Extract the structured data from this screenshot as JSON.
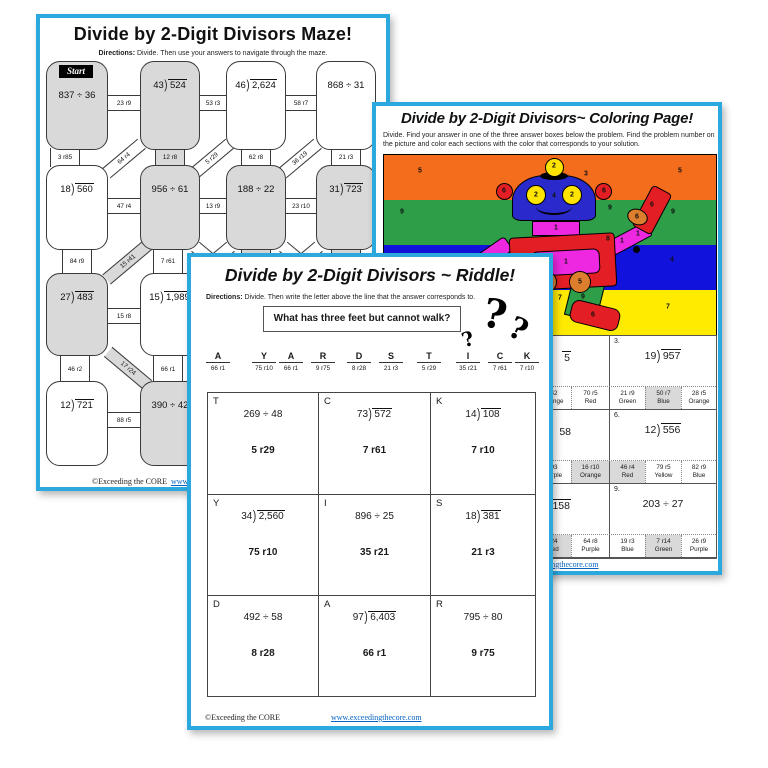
{
  "colors": {
    "page_border": "#2BA9DF",
    "shade_gray": "#D9D9D9",
    "stripe_orange": "#F36D1D",
    "stripe_green": "#2E9E49",
    "stripe_blue": "#1212DD",
    "stripe_yellow": "#FFEB00",
    "robot_blue": "#2929CC",
    "robot_red": "#E31E24",
    "robot_magenta": "#ED28E0",
    "robot_orange": "#DD7E2E",
    "robot_yellow": "#FFE400",
    "robot_green": "#2E9E49",
    "link_blue": "#0563C1"
  },
  "maze": {
    "title": "Divide by 2-Digit Divisors Maze!",
    "directions_label": "Directions:",
    "directions": "Divide. Then use your answers to navigate through the maze.",
    "start_label": "Start",
    "boxes": [
      {
        "problem": "837 ÷ 36",
        "row": 0,
        "col": 0,
        "shaded": true,
        "start": true
      },
      {
        "problem": "43)524",
        "row": 0,
        "col": 1,
        "shaded": true
      },
      {
        "problem": "46)2,624",
        "row": 0,
        "col": 2,
        "shaded": false
      },
      {
        "problem": "868 ÷ 31",
        "row": 0,
        "col": 3,
        "shaded": false
      },
      {
        "problem": "18)560",
        "row": 1,
        "col": 0,
        "shaded": false
      },
      {
        "problem": "956 ÷ 61",
        "row": 1,
        "col": 1,
        "shaded": true
      },
      {
        "problem": "188 ÷ 22",
        "row": 1,
        "col": 2,
        "shaded": true
      },
      {
        "problem": "31)723",
        "row": 1,
        "col": 3,
        "shaded": true
      },
      {
        "problem": "27)483",
        "row": 2,
        "col": 0,
        "shaded": true
      },
      {
        "problem": "15)1,989",
        "row": 2,
        "col": 1,
        "shaded": false
      },
      {
        "problem": "12)721",
        "row": 3,
        "col": 0,
        "shaded": false
      },
      {
        "problem": "390 ÷ 42",
        "row": 3,
        "col": 1,
        "shaded": true
      }
    ],
    "connectors": [
      {
        "label": "23 r9",
        "type": "h",
        "x": 84,
        "y": 85
      },
      {
        "label": "53 r3",
        "type": "h",
        "x": 173,
        "y": 85
      },
      {
        "label": "58 r7",
        "type": "h",
        "x": 261,
        "y": 85
      },
      {
        "label": "3 r85",
        "type": "v",
        "x": 25,
        "y": 140
      },
      {
        "label": "64 r4",
        "type": "d",
        "x": 84,
        "y": 140,
        "rot": -40
      },
      {
        "label": "12 r8",
        "type": "v",
        "x": 130,
        "y": 140,
        "shaded": true
      },
      {
        "label": "5 r29",
        "type": "d",
        "x": 172,
        "y": 140,
        "rot": -40
      },
      {
        "label": "62 r8",
        "type": "v",
        "x": 216,
        "y": 140
      },
      {
        "label": "36 r19",
        "type": "d",
        "x": 260,
        "y": 140,
        "rot": -40
      },
      {
        "label": "21 r3",
        "type": "v",
        "x": 306,
        "y": 140
      },
      {
        "label": "47 r4",
        "type": "h",
        "x": 84,
        "y": 188
      },
      {
        "label": "13 r9",
        "type": "h",
        "x": 173,
        "y": 188
      },
      {
        "label": "23 r10",
        "type": "h",
        "x": 261,
        "y": 188
      },
      {
        "label": "84 r9",
        "type": "v",
        "x": 37,
        "y": 243
      },
      {
        "label": "15 r41",
        "type": "d",
        "x": 88,
        "y": 243,
        "rot": -40,
        "shaded": true,
        "len": 56
      },
      {
        "label": "7 r61",
        "type": "v",
        "x": 128,
        "y": 243
      },
      {
        "label": "",
        "type": "v",
        "x": 216,
        "y": 243,
        "shaded": true
      },
      {
        "label": "",
        "type": "v",
        "x": 306,
        "y": 243,
        "shaded": true
      },
      {
        "label": "",
        "type": "d",
        "x": 173,
        "y": 243,
        "rot": 40
      },
      {
        "label": "",
        "type": "d",
        "x": 173,
        "y": 243,
        "rot": -40
      },
      {
        "label": "",
        "type": "d",
        "x": 261,
        "y": 243,
        "rot": 40
      },
      {
        "label": "",
        "type": "d",
        "x": 261,
        "y": 243,
        "rot": -40
      },
      {
        "label": "15 r8",
        "type": "h",
        "x": 84,
        "y": 298
      },
      {
        "label": "46 r2",
        "type": "v",
        "x": 35,
        "y": 350
      },
      {
        "label": "17 r24",
        "type": "d",
        "x": 88,
        "y": 350,
        "rot": 40,
        "shaded": true,
        "len": 52
      },
      {
        "label": "66 r1",
        "type": "v",
        "x": 128,
        "y": 350
      },
      {
        "label": "88 r5",
        "type": "h",
        "x": 84,
        "y": 402
      }
    ],
    "footer": {
      "copyright": "©Exceeding the CORE",
      "website": "www.exceedingthecore.com"
    }
  },
  "coloring": {
    "title": "Divide by 2-Digit Divisors~ Coloring Page!",
    "directions": "Divide.  Find your answer in one of the three answer boxes below the problem.  Find the problem number on the picture and color each sections with the color that corresponds to your solution.",
    "picture_numbers": [
      {
        "v": "5",
        "x": 36,
        "y": 16
      },
      {
        "v": "5",
        "x": 296,
        "y": 16
      },
      {
        "v": "2",
        "x": 170,
        "y": 11
      },
      {
        "v": "3",
        "x": 202,
        "y": 19
      },
      {
        "v": "6",
        "x": 120,
        "y": 36
      },
      {
        "v": "6",
        "x": 220,
        "y": 36
      },
      {
        "v": "2",
        "x": 152,
        "y": 40
      },
      {
        "v": "2",
        "x": 188,
        "y": 40
      },
      {
        "v": "4",
        "x": 170,
        "y": 41
      },
      {
        "v": "9",
        "x": 18,
        "y": 57
      },
      {
        "v": "9",
        "x": 226,
        "y": 53
      },
      {
        "v": "9",
        "x": 289,
        "y": 57
      },
      {
        "v": "6",
        "x": 268,
        "y": 50
      },
      {
        "v": "6",
        "x": 253,
        "y": 62
      },
      {
        "v": "1",
        "x": 238,
        "y": 86
      },
      {
        "v": "1",
        "x": 254,
        "y": 79
      },
      {
        "v": "1",
        "x": 172,
        "y": 73
      },
      {
        "v": "8",
        "x": 224,
        "y": 84
      },
      {
        "v": "1",
        "x": 182,
        "y": 107
      },
      {
        "v": "1",
        "x": 99,
        "y": 103
      },
      {
        "v": "4",
        "x": 136,
        "y": 112
      },
      {
        "v": "4",
        "x": 288,
        "y": 105
      },
      {
        "v": "5",
        "x": 162,
        "y": 127
      },
      {
        "v": "5",
        "x": 196,
        "y": 127
      },
      {
        "v": "9",
        "x": 199,
        "y": 142
      },
      {
        "v": "7",
        "x": 176,
        "y": 143
      },
      {
        "v": "7",
        "x": 284,
        "y": 152
      },
      {
        "v": "6",
        "x": 209,
        "y": 160
      }
    ],
    "grid": {
      "mid_problems": [
        {
          "fragment": "5",
          "overline": true
        },
        {
          "fragment": "58",
          "overline": false
        },
        {
          "fragment": "158",
          "overline": true
        }
      ],
      "mid_answers": [
        [
          {
            "answer": "r42",
            "color": "Orange"
          },
          {
            "answer": "70 r5",
            "color": "Red"
          }
        ],
        [
          {
            "answer": "r93",
            "color": "Purple"
          },
          {
            "answer": "16 r10",
            "color": "Orange",
            "selected": true
          }
        ],
        [
          {
            "answer": "r24",
            "color": "Red",
            "selected": true
          },
          {
            "answer": "64 r8",
            "color": "Purple"
          }
        ]
      ],
      "right_problems": [
        {
          "num": "3.",
          "problem": "19)957"
        },
        {
          "num": "6.",
          "problem": "12)556"
        },
        {
          "num": "9.",
          "problem": "203 ÷ 27"
        }
      ],
      "right_answers": [
        [
          {
            "answer": "21 r9",
            "color": "Green"
          },
          {
            "answer": "50 r7",
            "color": "Blue",
            "selected": true
          },
          {
            "answer": "28 r5",
            "color": "Orange"
          }
        ],
        [
          {
            "answer": "46 r4",
            "color": "Red",
            "selected": true
          },
          {
            "answer": "79 r5",
            "color": "Yellow"
          },
          {
            "answer": "82 r9",
            "color": "Blue"
          }
        ],
        [
          {
            "answer": "19 r3",
            "color": "Blue"
          },
          {
            "answer": "7 r14",
            "color": "Green",
            "selected": true
          },
          {
            "answer": "26 r9",
            "color": "Purple"
          }
        ]
      ]
    },
    "footer": {
      "website": "www.exceedingthecore.com"
    }
  },
  "riddle": {
    "title": "Divide by 2-Digit Divisors ~ Riddle!",
    "directions_label": "Directions:",
    "directions": "Divide.  Then write the letter above the line that the answer corresponds to.",
    "question": "What has three feet but cannot walk?",
    "question_marks": [
      "?",
      "?",
      "?"
    ],
    "answer_blanks": [
      {
        "letter": "A",
        "answer": "66 r1"
      },
      {
        "letter": "Y",
        "answer": "75 r10"
      },
      {
        "letter": "A",
        "answer": "66 r1"
      },
      {
        "letter": "R",
        "answer": "9 r75"
      },
      {
        "letter": "D",
        "answer": "8 r28"
      },
      {
        "letter": "S",
        "answer": "21 r3"
      },
      {
        "letter": "T",
        "answer": "5 r29"
      },
      {
        "letter": "I",
        "answer": "35 r21"
      },
      {
        "letter": "C",
        "answer": "7 r61"
      },
      {
        "letter": "K",
        "answer": "7 r10"
      }
    ],
    "problems": [
      {
        "letter": "T",
        "problem": "269 ÷ 48",
        "answer": "5 r29"
      },
      {
        "letter": "C",
        "problem": "73)572",
        "answer": "7 r61"
      },
      {
        "letter": "K",
        "problem": "14)108",
        "answer": "7 r10"
      },
      {
        "letter": "Y",
        "problem": "34)2,560",
        "answer": "75 r10"
      },
      {
        "letter": "I",
        "problem": "896 ÷ 25",
        "answer": "35 r21"
      },
      {
        "letter": "S",
        "problem": "18)381",
        "answer": "21 r3"
      },
      {
        "letter": "D",
        "problem": "492 ÷ 58",
        "answer": "8 r28"
      },
      {
        "letter": "A",
        "problem": "97)6,403",
        "answer": "66 r1"
      },
      {
        "letter": "R",
        "problem": "795 ÷ 80",
        "answer": "9 r75"
      }
    ],
    "footer": {
      "copyright": "©Exceeding the CORE",
      "website": "www.exceedingthecore.com"
    }
  }
}
